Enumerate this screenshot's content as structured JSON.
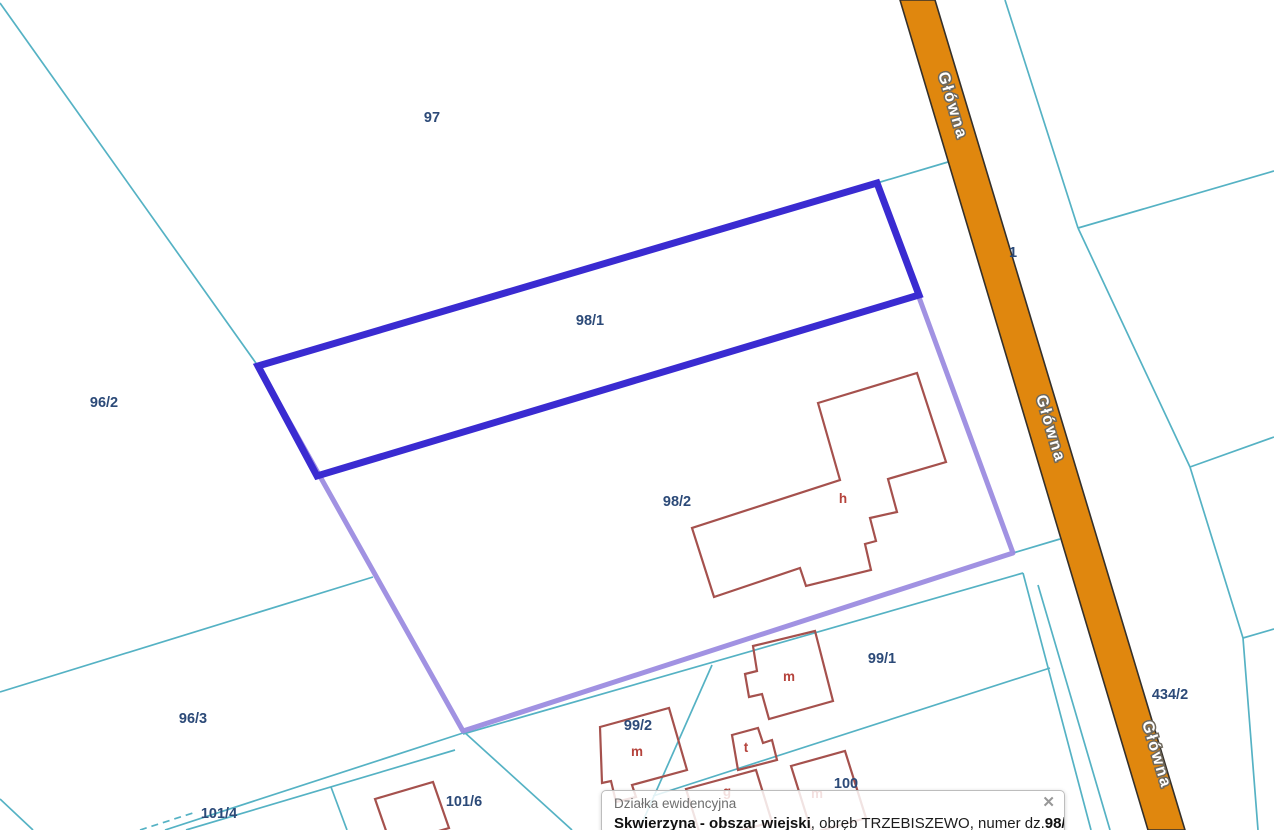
{
  "app": {
    "type": "cadastral-map-viewer"
  },
  "map": {
    "selected_parcel": "98/1",
    "parcel_labels": [
      {
        "id": "97",
        "x": 432,
        "y": 122
      },
      {
        "id": "96/2",
        "x": 104,
        "y": 407
      },
      {
        "id": "96/3",
        "x": 193,
        "y": 723
      },
      {
        "id": "98/1",
        "x": 590,
        "y": 325
      },
      {
        "id": "98/2",
        "x": 677,
        "y": 506
      },
      {
        "id": "99/1",
        "x": 882,
        "y": 663
      },
      {
        "id": "99/2",
        "x": 638,
        "y": 730
      },
      {
        "id": "100",
        "x": 846,
        "y": 788
      },
      {
        "id": "101/4",
        "x": 219,
        "y": 818
      },
      {
        "id": "101/6",
        "x": 464,
        "y": 806
      },
      {
        "id": "434/2",
        "x": 1170,
        "y": 699
      },
      {
        "id": "1",
        "x": 1013,
        "y": 257
      }
    ],
    "building_labels": [
      {
        "id": "h",
        "x": 843,
        "y": 503
      },
      {
        "id": "m",
        "x": 789,
        "y": 681
      },
      {
        "id": "m",
        "x": 637,
        "y": 756
      },
      {
        "id": "t",
        "x": 746,
        "y": 752
      },
      {
        "id": "g",
        "x": 727,
        "y": 796
      },
      {
        "id": "m",
        "x": 817,
        "y": 798
      }
    ],
    "road": {
      "name": "Główna",
      "labels": [
        {
          "x": 948,
          "y": 107,
          "rot": 73.4
        },
        {
          "x": 1046,
          "y": 430,
          "rot": 73.4
        },
        {
          "x": 1152,
          "y": 756,
          "rot": 73.4
        }
      ]
    }
  },
  "popup": {
    "title": "Działka ewidencyjna",
    "close_label": "✕",
    "body": {
      "municipality": "Skwierzyna - obszar wiejski",
      "obreb_prefix": ", obręb ",
      "obreb": "TRZEBISZEWO",
      "number_prefix": ", numer dz.",
      "parcel_number": "98/1"
    }
  },
  "colors": {
    "parcel_line": "#55b2c4",
    "selected_outline": "#3a2bd1",
    "selection_halo": "#9c8ce0",
    "road_fill": "#e0870e",
    "road_border": "#35302a",
    "building_line": "#a5514d",
    "parcel_label": "#2c4a78",
    "building_label": "#b5433c"
  }
}
